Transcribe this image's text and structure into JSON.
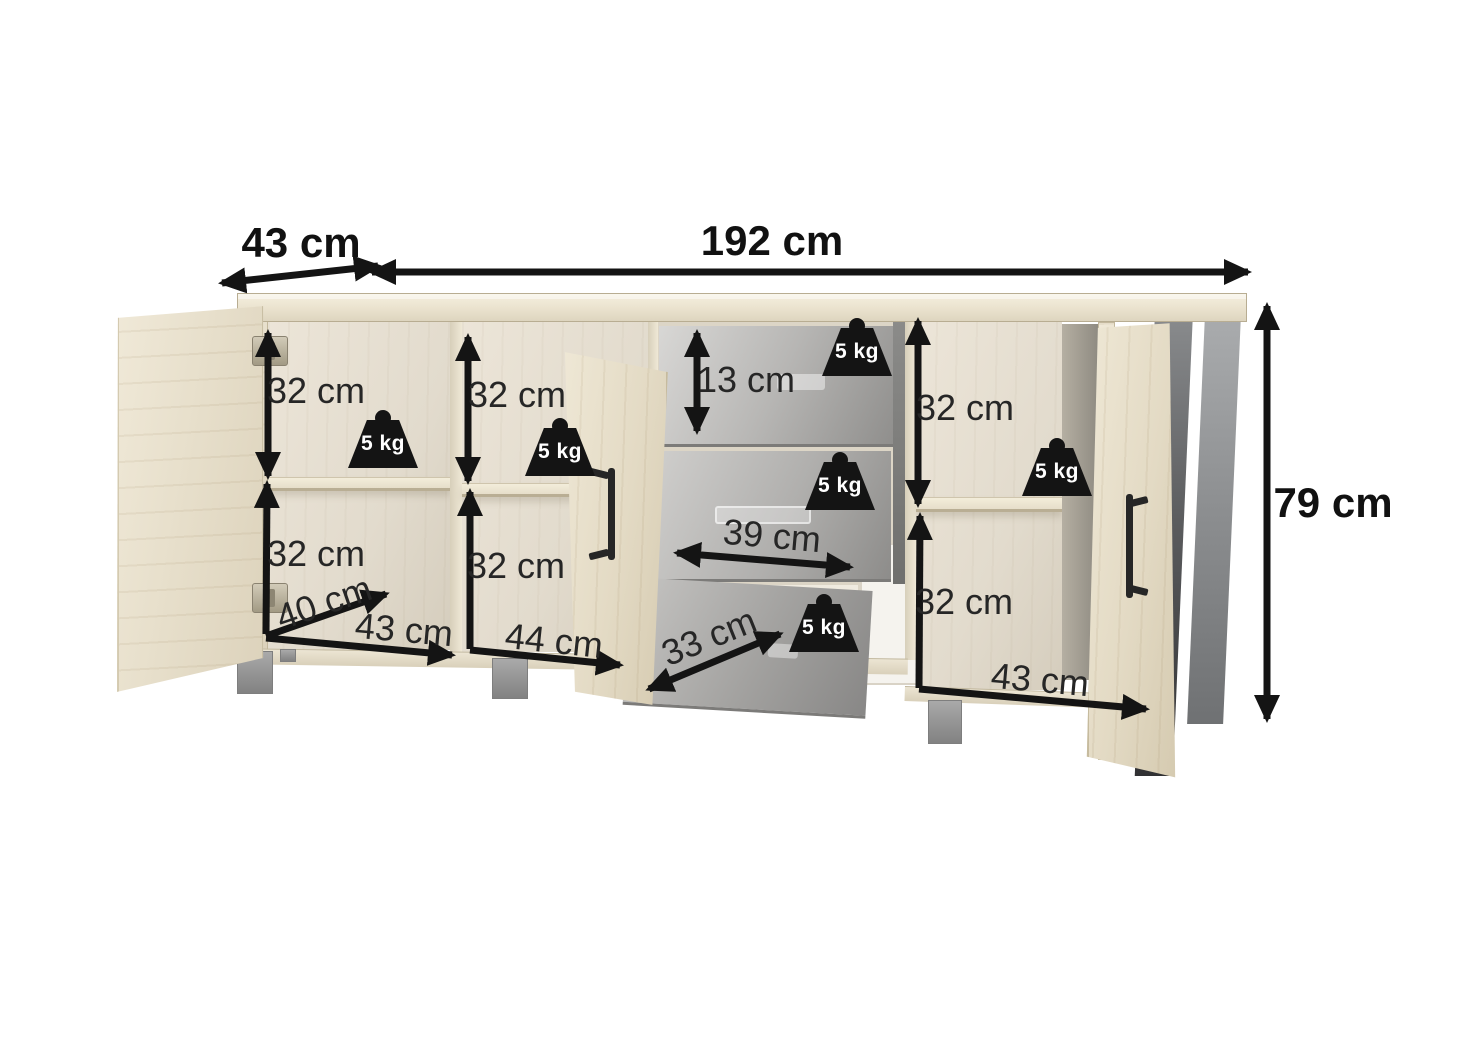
{
  "dimensions": {
    "top_depth": "43 cm",
    "total_width": "192 cm",
    "total_height": "79 cm",
    "left_upper_height": "32 cm",
    "left_lower_height": "32 cm",
    "left_depth": "40 cm",
    "left_width": "43 cm",
    "center_upper_height": "32 cm",
    "center_lower_height": "32 cm",
    "center_width": "44 cm",
    "top_drawer_height": "13 cm",
    "middle_drawer_width": "39 cm",
    "bottom_drawer_width": "33 cm",
    "right_upper_height": "32 cm",
    "right_lower_height": "32 cm",
    "right_width": "43 cm"
  },
  "weights": {
    "label": "5 kg"
  },
  "colors": {
    "wood": "#e9e2d0",
    "interior": "#e7e0d3",
    "drawer_gray": "#b0afad",
    "metal_leg_dark": "#3a3b3d",
    "metal_leg_light": "#97999b",
    "arrow": "#141414"
  }
}
